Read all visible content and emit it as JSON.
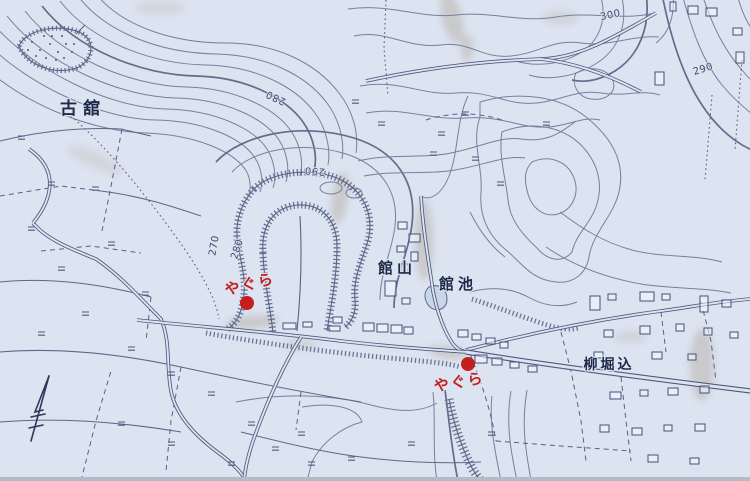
{
  "map": {
    "colors": {
      "background": "#dce3f1",
      "contour": "#76819e",
      "ink": "#1c2a47",
      "marker": "#c41f1f",
      "water": "#c9d5ea",
      "stain": "#9b8a6e"
    },
    "place_labels": [
      {
        "id": "furudate",
        "text": "古舘"
      },
      {
        "id": "tateyama",
        "text": "館山"
      },
      {
        "id": "tateike",
        "text": "館池"
      },
      {
        "id": "yanagihorikome",
        "text": "柳堀込"
      }
    ],
    "site_markers": [
      {
        "label": "やぐら"
      },
      {
        "label": "やぐら"
      }
    ],
    "elevation_labels": [
      {
        "text": "280"
      },
      {
        "text": "290"
      },
      {
        "text": "270"
      },
      {
        "text": "280"
      },
      {
        "text": "300"
      },
      {
        "text": "290"
      }
    ],
    "legend_symbols": {
      "rice_paddy_mark": "=",
      "north_arrow": "↑"
    }
  }
}
